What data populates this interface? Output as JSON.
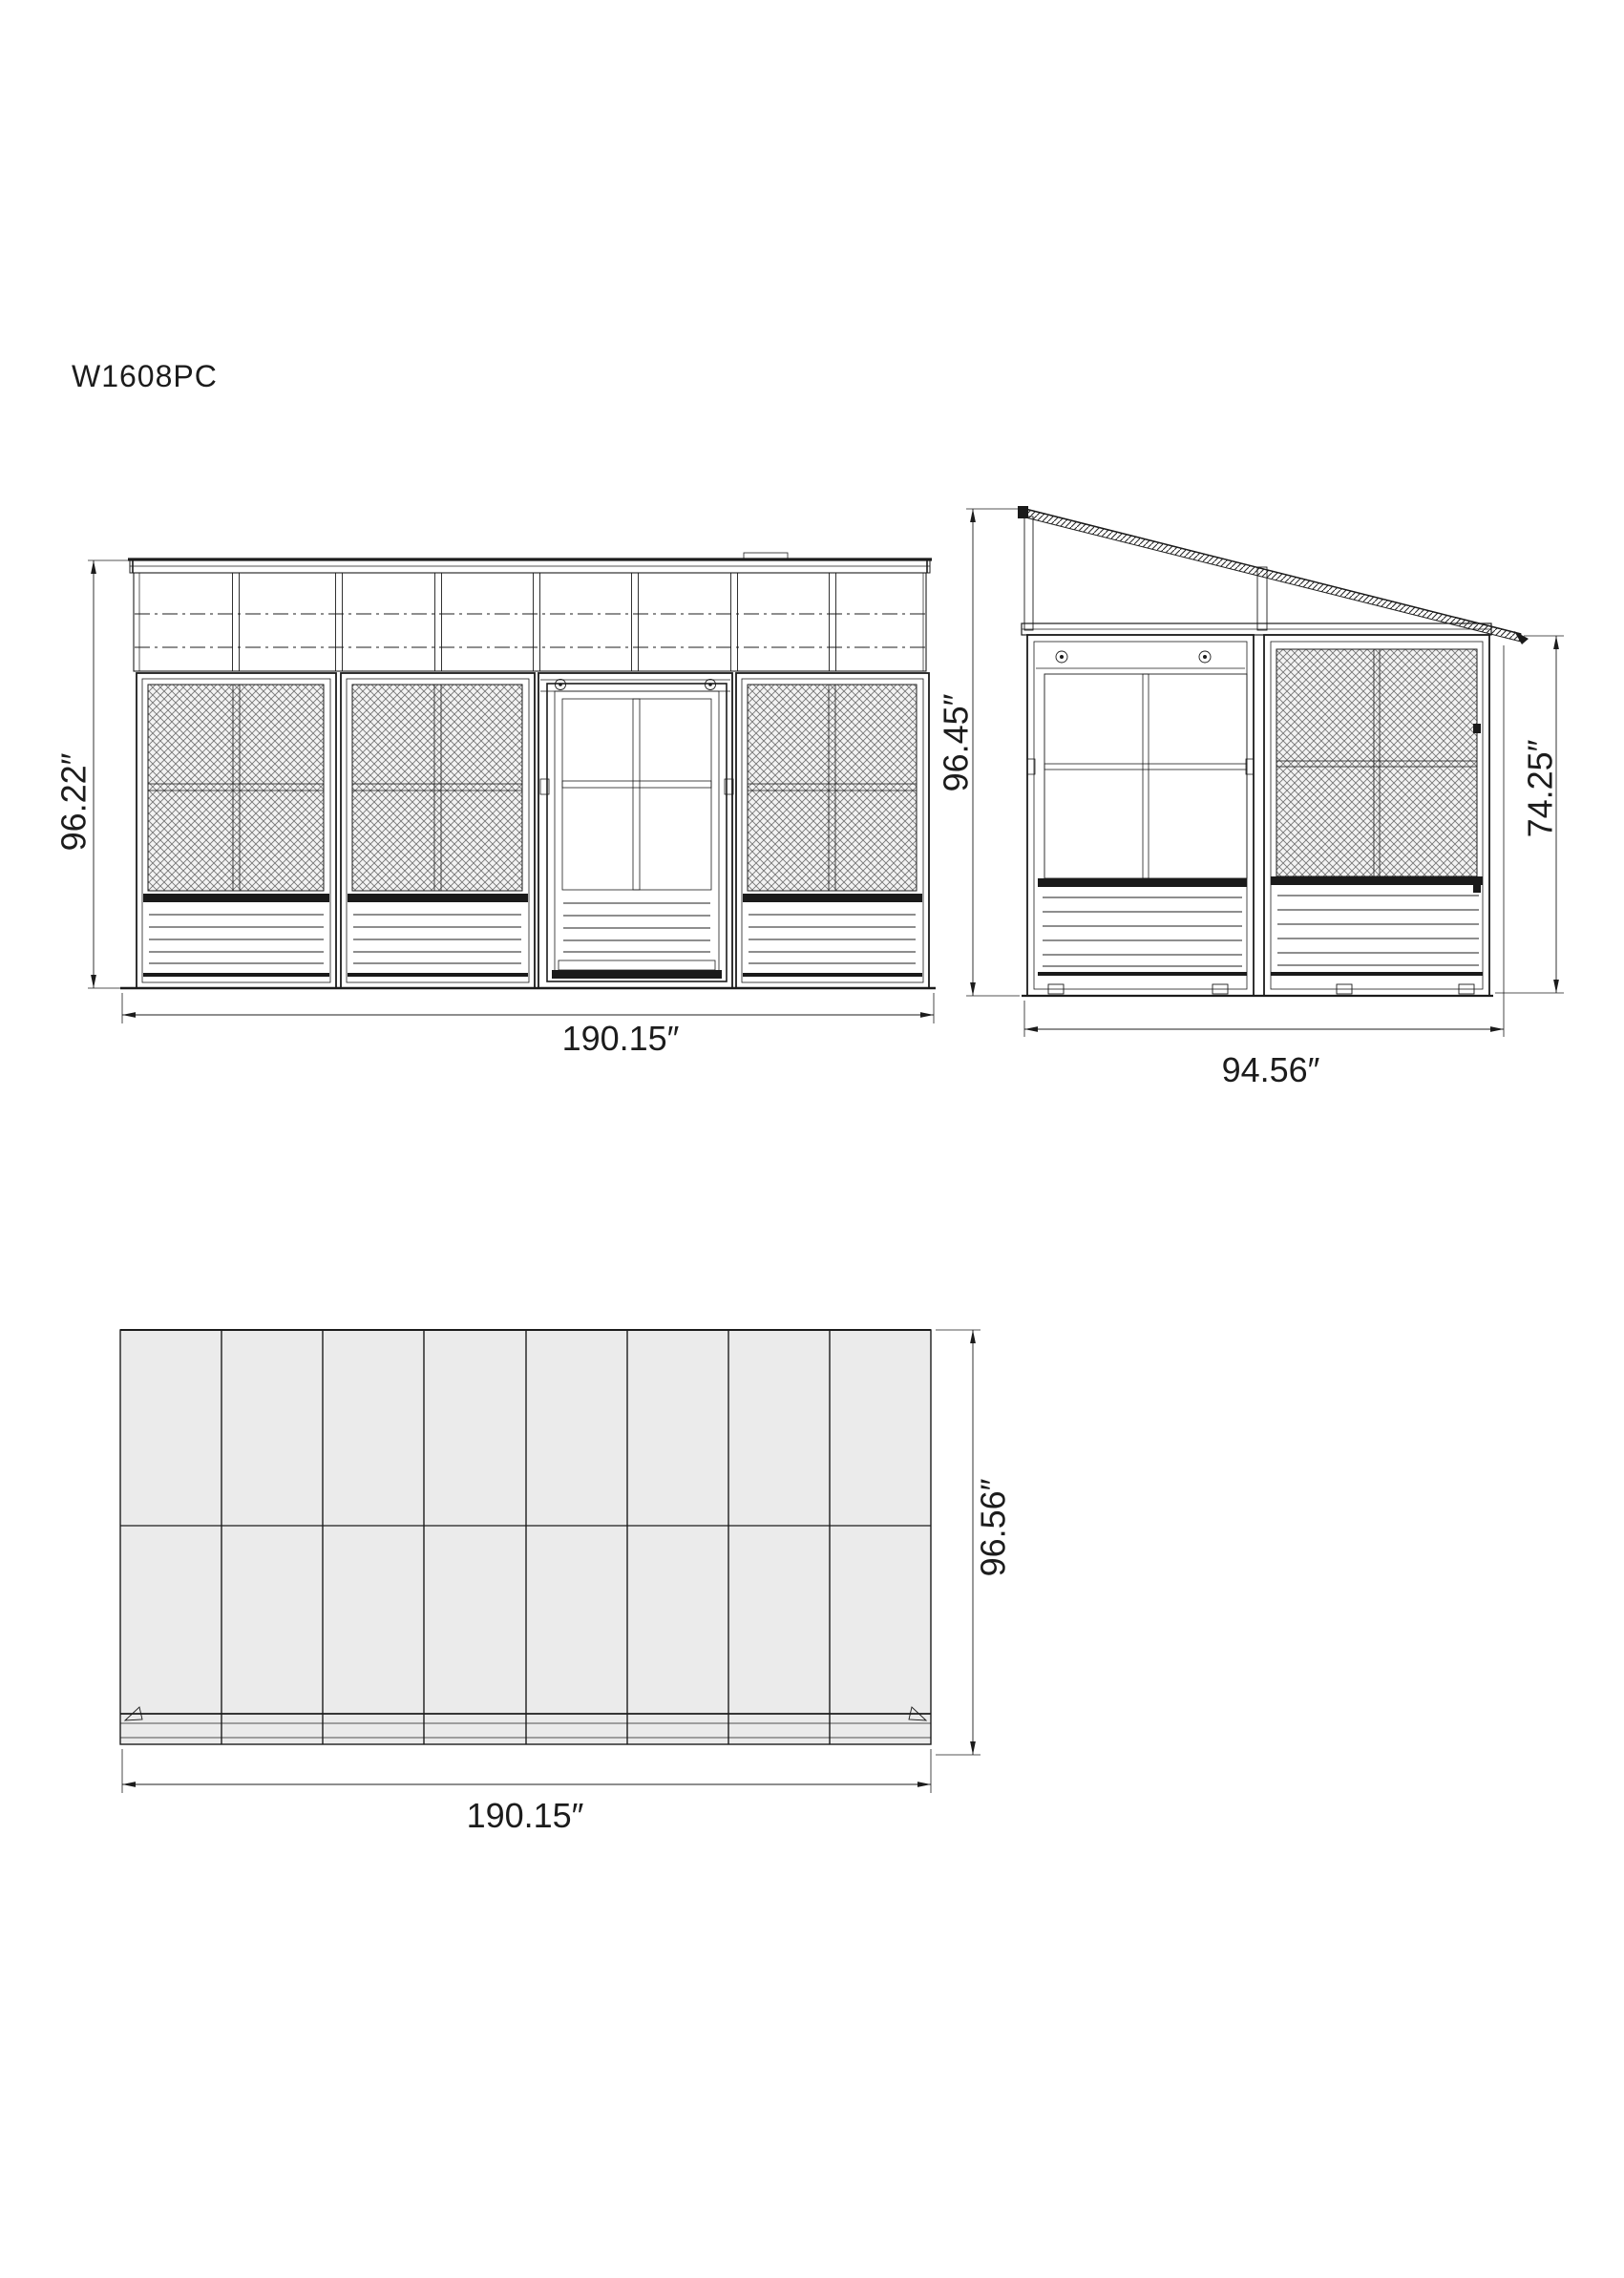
{
  "title": "W1608PC",
  "views": {
    "front": {
      "name": "Front elevation",
      "dim_height": "96.22″",
      "dim_width": "190.15″"
    },
    "side": {
      "name": "Side elevation",
      "dim_total_height": "96.45″",
      "dim_wall_height": "74.25″",
      "dim_width": "94.56″"
    },
    "plan": {
      "name": "Roof plan",
      "dim_depth": "96.56″",
      "dim_width": "190.15″"
    }
  }
}
